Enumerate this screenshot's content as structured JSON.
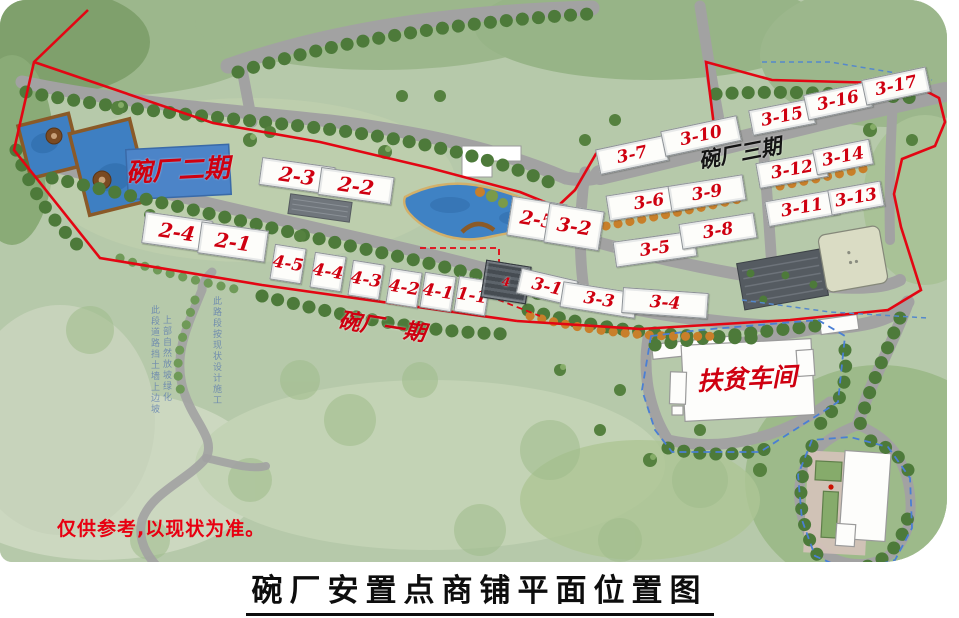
{
  "meta": {
    "title": "碗厂安置点商铺平面位置图",
    "note": "仅供参考,以现状为准。"
  },
  "colors": {
    "boundary_red": "#e30613",
    "boundary_blue": "#4a7fd4",
    "label_red": "#cf0010",
    "water": "#3f82c4",
    "phase2_block": "#4c84c8"
  },
  "map": {
    "phase_labels": [
      {
        "id": "phase2",
        "text": "碗厂二期",
        "color": "#cf0010",
        "x": 178,
        "y": 171,
        "rot": -3,
        "size": 26
      },
      {
        "id": "phase3",
        "text": "碗厂三期",
        "color": "#141414",
        "x": 740,
        "y": 153,
        "rot": -11,
        "size": 21
      },
      {
        "id": "phase1",
        "text": "碗厂一期",
        "color": "#cf0010",
        "x": 382,
        "y": 327,
        "rot": 9,
        "size": 22
      },
      {
        "id": "workshop",
        "text": "扶贫车间",
        "color": "#cf0010",
        "x": 747,
        "y": 379,
        "rot": -3,
        "size": 25
      }
    ],
    "buildings": [
      {
        "label": "2-3",
        "x": 296,
        "y": 175,
        "w": 72,
        "h": 26,
        "rot": 8,
        "fs": 20
      },
      {
        "label": "2-2",
        "x": 355,
        "y": 185,
        "w": 72,
        "h": 26,
        "rot": 8,
        "fs": 20
      },
      {
        "label": "2-4",
        "x": 176,
        "y": 231,
        "w": 66,
        "h": 30,
        "rot": 8,
        "fs": 20
      },
      {
        "label": "2-1",
        "x": 232,
        "y": 241,
        "w": 66,
        "h": 30,
        "rot": 8,
        "fs": 20
      },
      {
        "label": "2-5",
        "x": 536,
        "y": 219,
        "w": 54,
        "h": 38,
        "rot": 9,
        "fs": 19
      },
      {
        "label": "3-2",
        "x": 573,
        "y": 226,
        "w": 54,
        "h": 38,
        "rot": 9,
        "fs": 19
      },
      {
        "label": "4-5",
        "x": 287,
        "y": 263,
        "w": 30,
        "h": 34,
        "rot": 9,
        "fs": 17
      },
      {
        "label": "4-4",
        "x": 327,
        "y": 271,
        "w": 30,
        "h": 34,
        "rot": 9,
        "fs": 17
      },
      {
        "label": "4-3",
        "x": 365,
        "y": 279,
        "w": 30,
        "h": 34,
        "rot": 9,
        "fs": 17
      },
      {
        "label": "4-2",
        "x": 403,
        "y": 287,
        "w": 30,
        "h": 34,
        "rot": 9,
        "fs": 17
      },
      {
        "label": "4-1",
        "x": 437,
        "y": 291,
        "w": 30,
        "h": 34,
        "rot": 9,
        "fs": 17
      },
      {
        "label": "1-1",
        "x": 471,
        "y": 295,
        "w": 30,
        "h": 34,
        "rot": 9,
        "fs": 17
      },
      {
        "label": "4",
        "x": 505,
        "y": 281,
        "w": 44,
        "h": 36,
        "rot": 9,
        "fs": 12,
        "cls": "dark"
      },
      {
        "label": "3-1",
        "x": 546,
        "y": 286,
        "w": 56,
        "h": 24,
        "rot": 13,
        "fs": 17
      },
      {
        "label": "3-3",
        "x": 598,
        "y": 299,
        "w": 74,
        "h": 24,
        "rot": 9,
        "fs": 17
      },
      {
        "label": "3-4",
        "x": 664,
        "y": 302,
        "w": 84,
        "h": 24,
        "rot": 4,
        "fs": 17
      },
      {
        "label": "3-5",
        "x": 654,
        "y": 248,
        "w": 80,
        "h": 24,
        "rot": -8,
        "fs": 17
      },
      {
        "label": "3-8",
        "x": 717,
        "y": 230,
        "w": 74,
        "h": 24,
        "rot": -9,
        "fs": 17
      },
      {
        "label": "3-6",
        "x": 648,
        "y": 201,
        "w": 82,
        "h": 24,
        "rot": -9,
        "fs": 17
      },
      {
        "label": "3-9",
        "x": 706,
        "y": 192,
        "w": 74,
        "h": 24,
        "rot": -9,
        "fs": 17
      },
      {
        "label": "3-7",
        "x": 631,
        "y": 154,
        "w": 68,
        "h": 24,
        "rot": -12,
        "fs": 17
      },
      {
        "label": "3-10",
        "x": 700,
        "y": 135,
        "w": 76,
        "h": 24,
        "rot": -12,
        "fs": 17
      },
      {
        "label": "3-15",
        "x": 781,
        "y": 116,
        "w": 62,
        "h": 24,
        "rot": -11,
        "fs": 17
      },
      {
        "label": "3-16",
        "x": 837,
        "y": 100,
        "w": 64,
        "h": 24,
        "rot": -12,
        "fs": 17
      },
      {
        "label": "3-17",
        "x": 895,
        "y": 85,
        "w": 64,
        "h": 24,
        "rot": -12,
        "fs": 17
      },
      {
        "label": "3-12",
        "x": 791,
        "y": 169,
        "w": 68,
        "h": 24,
        "rot": -10,
        "fs": 17
      },
      {
        "label": "3-14",
        "x": 842,
        "y": 156,
        "w": 56,
        "h": 24,
        "rot": -11,
        "fs": 17
      },
      {
        "label": "3-11",
        "x": 801,
        "y": 207,
        "w": 70,
        "h": 24,
        "rot": -10,
        "fs": 17
      },
      {
        "label": "3-13",
        "x": 855,
        "y": 197,
        "w": 52,
        "h": 24,
        "rot": -10,
        "fs": 17
      }
    ],
    "road_notes": [
      {
        "text": "此段道路挡土墙上边坡",
        "x": 148,
        "y": 305
      },
      {
        "text": "上部自然放坡绿化",
        "x": 160,
        "y": 315
      },
      {
        "text": "此路段按现状设计施工",
        "x": 210,
        "y": 296
      }
    ]
  }
}
